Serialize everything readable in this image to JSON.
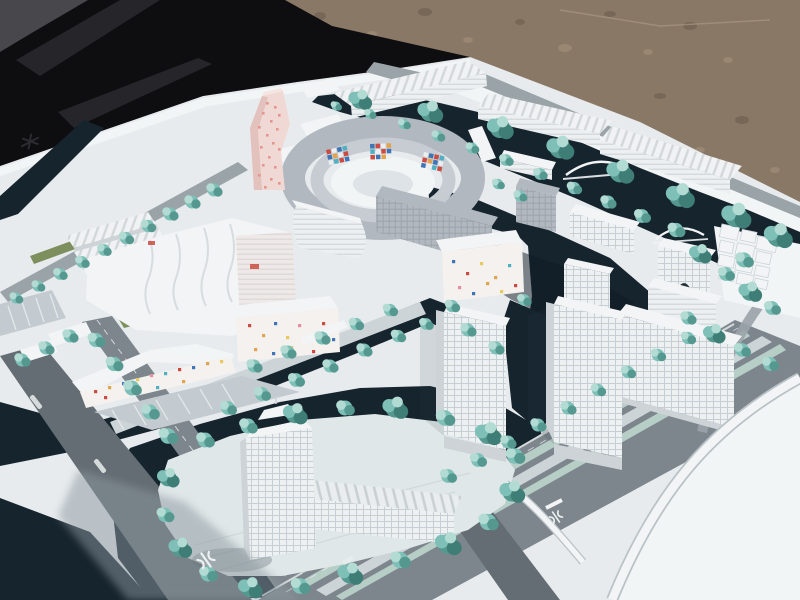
{
  "scene": {
    "type": "outdoor photograph",
    "subject": "architectural scale model of a waterfront urban masterplan",
    "setting": "white maquette lying on gravel ground, partly bordered by a black cover fabric"
  },
  "palette": {
    "gravel": "#8a7866",
    "gravel_dark": "#5f5245",
    "gravel_light": "#a79680",
    "tarp": "#0e0e10",
    "tarp_fold": "#26262a",
    "tarp_fold_light": "#47474c",
    "base": "#e7ebee",
    "base_bright": "#f2f5f6",
    "water": "#16242e",
    "water_deep": "#0d1922",
    "quay": "#d9e0e4",
    "road": "#7d868c",
    "road_light": "#9aa3a8",
    "road_dark": "#646d73",
    "road_pale": "#ccd4d8",
    "plaza": "#c3cbd0",
    "median": "#b7cec7",
    "lane": "#e9edec",
    "grass": "#7e8f5e",
    "grass_light": "#93a46b",
    "island": "#dfe7e8",
    "tree": "#7ec0b8",
    "tree_light": "#b2dbd4",
    "tree_dark": "#54988f",
    "tree_deep": "#3f7e76",
    "bldg": "#f2f4f5",
    "bldg_face": "#eef1f2",
    "bldg_shadow": "#cdd3d7",
    "bldg_dark": "#b9c0c6",
    "slab": "#b1b8bf",
    "slab_dark": "#9aa1a8",
    "pink": "#f0d9d5",
    "pink_shade": "#e3c2bd",
    "pink_dot": "#e4968e",
    "confetti_bg": "#f4f1ee",
    "confetti_pink": "#e590a0",
    "mosaic_red": "#cb4a41",
    "mosaic_blue": "#3f74b6",
    "mosaic_teal": "#4fb0c4",
    "mosaic_orange": "#e2a34e",
    "mosaic_yellow": "#e6c95f",
    "shadow": "#8d99a0",
    "glyph_dark": "#2b2b30",
    "glyph_white": "#eef1f2"
  },
  "elements": {
    "ground": "sun-baked gravel ground",
    "tarp": "black cover fabric",
    "base": "white model baseboard",
    "water": "dark navy canal network",
    "north_sheds": "ribbed-roof halls along the north edge",
    "pink_tower": "twisting landmark tower with pink speckled facade",
    "mosaic_ring": "elliptical courtyard block with colored mosaic panels",
    "wavy_complex": "wave-roofed retail complex",
    "confetti_blocks": "white housing blocks with confetti-colored windows",
    "gray_slabs": "gray mid-rise slabs",
    "right_cubes": "cluster of small cubic volumes",
    "tower_cluster": "waterfront high-rise towers",
    "island_tower": "translucent landmark tower on a garden island",
    "boulevard": "main boulevard with planted medians",
    "ramp": "curved expressway ramp on white ground",
    "bridges": "arched canal bridges",
    "trees": "frosted teal model trees",
    "marks": "rail-logo road markings and small road-name labels"
  }
}
